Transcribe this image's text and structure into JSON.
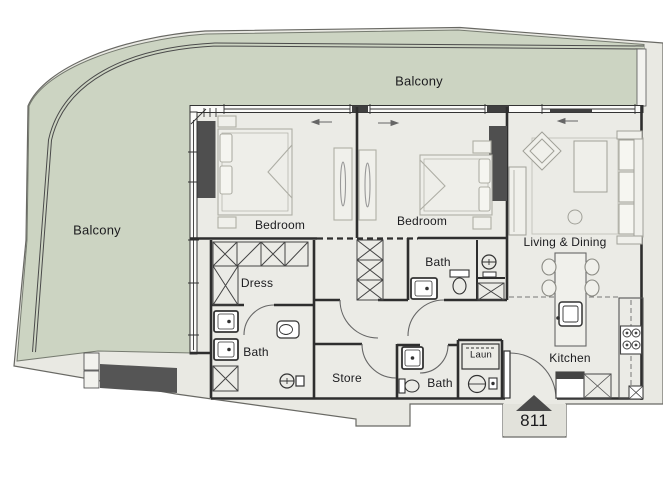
{
  "unit": {
    "number": "811"
  },
  "labels": {
    "balcony_top": "Balcony",
    "balcony_left": "Balcony",
    "bedroom_1": "Bedroom",
    "bedroom_2": "Bedroom",
    "living_dining": "Living & Dining",
    "dress": "Dress",
    "bath_master": "Bath",
    "bath_ensuite": "Bath",
    "bath_guest": "Bath",
    "store": "Store",
    "laundry": "Laun",
    "kitchen": "Kitchen"
  },
  "colors": {
    "balcony_green": "#ccd4c2",
    "interior_floor": "#ebebe6",
    "building_plate": "#e9e9e3",
    "wall": "#2e2e2e",
    "column": "#4f4f4f",
    "entry_marker": "#4a4a4a"
  },
  "icons": {
    "entry_arrow": "entry-direction-triangle",
    "shower": "shower-head-icon",
    "washer": "washing-machine-icon",
    "hob": "four-burner-hob-icon"
  }
}
